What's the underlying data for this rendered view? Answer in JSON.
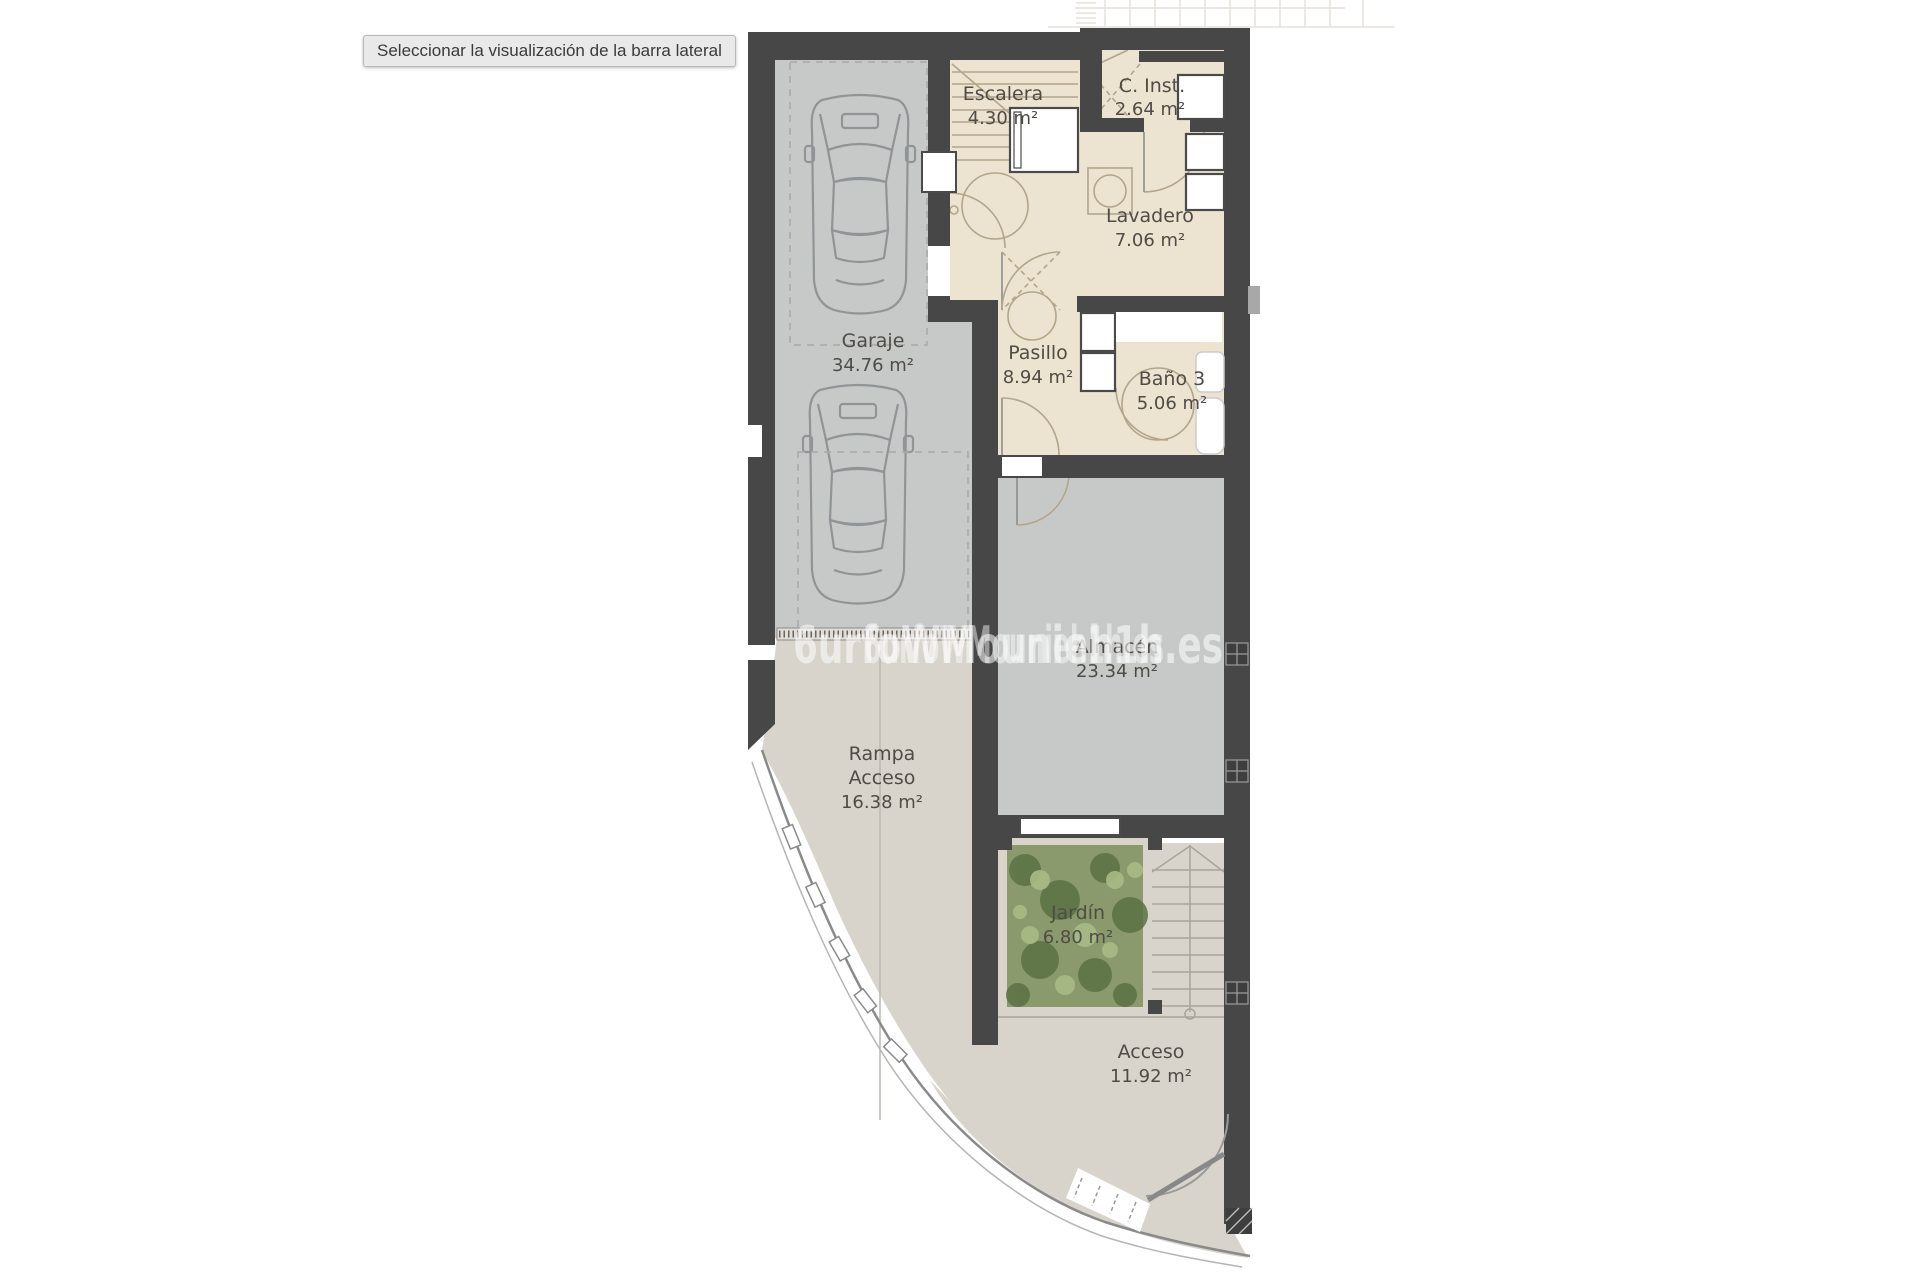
{
  "tooltip": {
    "text": "Seleccionar la visualización de la barra lateral"
  },
  "floorplan": {
    "watermark": "6urfoWMounieh1h.es",
    "colors": {
      "wall": "#474747",
      "floor_warm": "#ece3d1",
      "floor_gray": "#c7c9c8",
      "paving": "#d8d4cc",
      "garden_base": "#8a9a6c",
      "garden_dark": "#5b7244",
      "garden_light": "#a9bb85",
      "label_text": "#4f4c45",
      "watermark_color": "#ffffff"
    },
    "rooms": [
      {
        "id": "escalera",
        "line1": "Escalera",
        "area": "4.30 m²"
      },
      {
        "id": "c-inst",
        "line1": "C. Inst.",
        "area": "2.64 m²"
      },
      {
        "id": "lavadero",
        "line1": "Lavadero",
        "area": "7.06 m²"
      },
      {
        "id": "garaje",
        "line1": "Garaje",
        "area": "34.76 m²"
      },
      {
        "id": "pasillo",
        "line1": "Pasillo",
        "area": "8.94 m²"
      },
      {
        "id": "bano-3",
        "line1": "Baño 3",
        "area": "5.06 m²"
      },
      {
        "id": "almacen",
        "line1": "Almacén",
        "area": "23.34 m²"
      },
      {
        "id": "rampa-acceso",
        "line1": "Rampa",
        "line2": "Acceso",
        "area": "16.38 m²"
      },
      {
        "id": "jardin",
        "line1": "Jardín",
        "area": "6.80 m²"
      },
      {
        "id": "acceso",
        "line1": "Acceso",
        "area": "11.92 m²"
      }
    ]
  }
}
